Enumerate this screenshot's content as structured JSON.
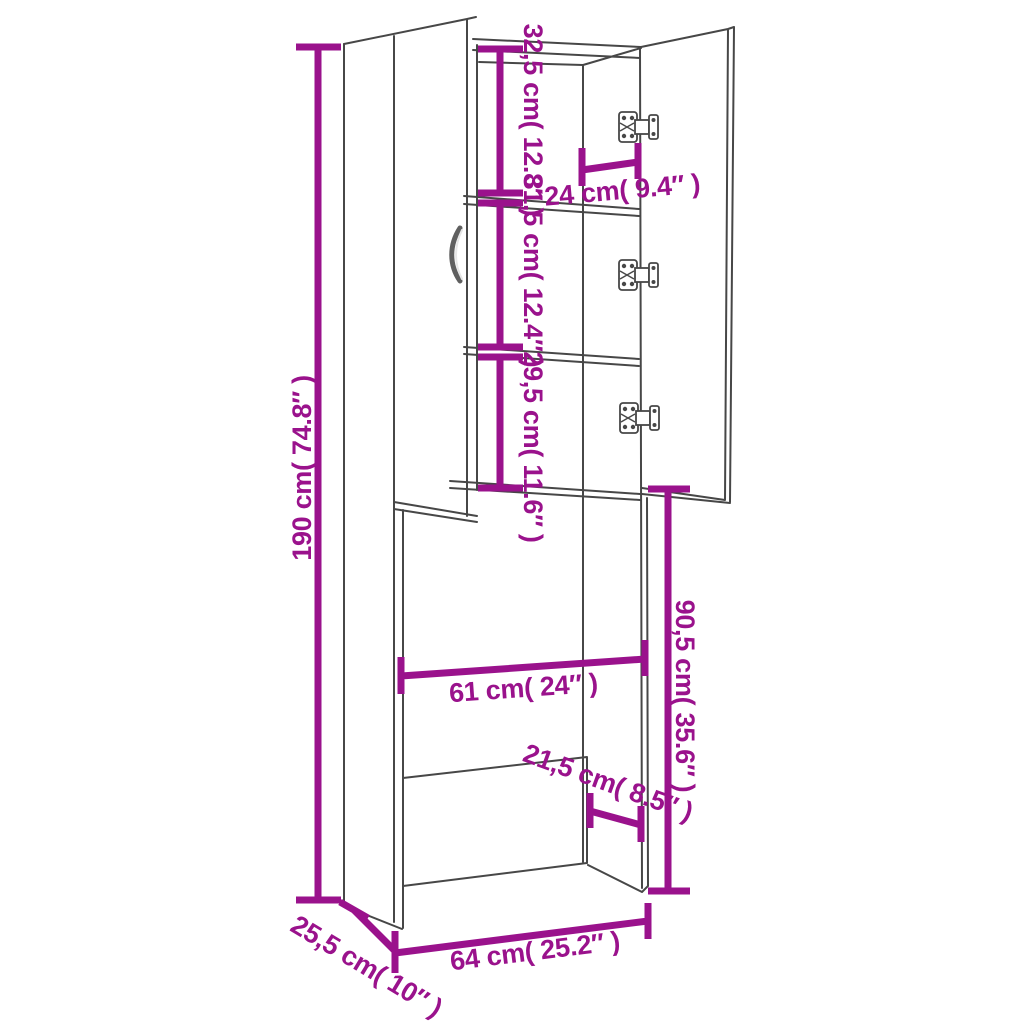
{
  "page": {
    "background": "#ffffff",
    "description": "Dimension line drawing of a tall washing machine storage cabinet with two doors (right door open) and three shelves"
  },
  "colors": {
    "dimension_accent": "#9A128C",
    "drawing_line": "#474747"
  },
  "dimensions": {
    "total_height": {
      "label": "190 cm( 74.8″  )",
      "cm": "190",
      "inches": "74.8"
    },
    "top_shelf_spacing": {
      "label": "32,5 cm( 12.8″  )",
      "cm": "32,5",
      "inches": "12.8"
    },
    "interior_depth_top": {
      "label": "24 cm( 9.4″  )",
      "cm": "24",
      "inches": "9.4"
    },
    "middle_shelf_spacing": {
      "label": "31,5 cm( 12.4″  )",
      "cm": "31,5",
      "inches": "12.4"
    },
    "bottom_shelf_spacing": {
      "label": "29,5 cm( 11.6″  )",
      "cm": "29,5",
      "inches": "11.6"
    },
    "opening_height": {
      "label": "90,5 cm( 35.6″  )",
      "cm": "90,5",
      "inches": "35.6"
    },
    "opening_width": {
      "label": "61 cm( 24″  )",
      "cm": "61",
      "inches": "24"
    },
    "bottom_panel_depth": {
      "label": "21,5 cm( 8.5″  )",
      "cm": "21,5",
      "inches": "8.5"
    },
    "total_width": {
      "label": "64 cm( 25.2″  )",
      "cm": "64",
      "inches": "25.2"
    },
    "total_depth": {
      "label": "25,5 cm( 10″ )",
      "cm": "25,5",
      "inches": "10"
    }
  }
}
